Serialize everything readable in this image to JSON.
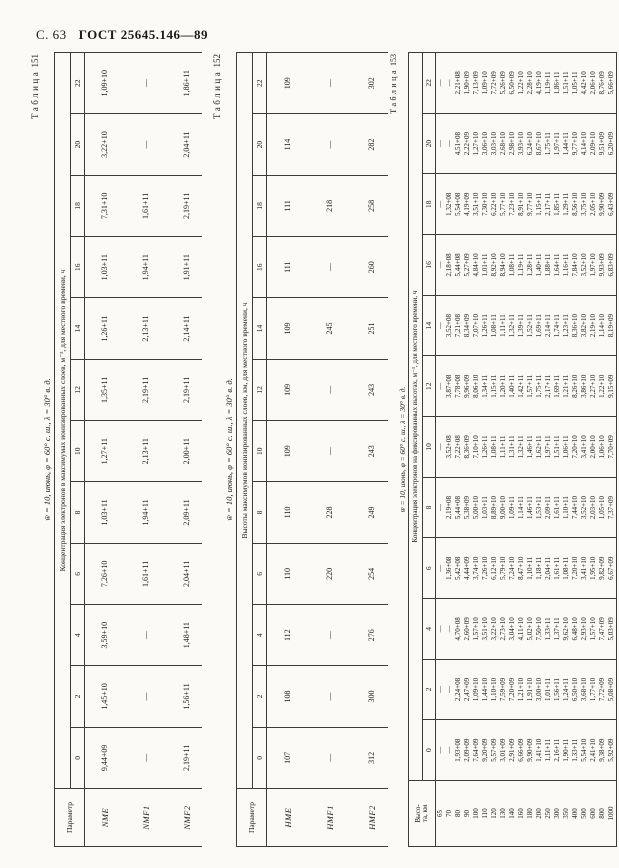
{
  "page": {
    "page_label": "С. 63",
    "gost_label": "ГОСТ 25645.146—89"
  },
  "tables": [
    {
      "label_word": "Таблица",
      "label_num": "151",
      "condition": "w̄ = 10, июнь, φ = 60° с. ш., λ = 30° в. д.",
      "caption": "Концентрация электронов в максимумах ионизированных слоев, м⁻³, для местного времени, ч",
      "corner": "Параметр",
      "hours": [
        "0",
        "2",
        "4",
        "6",
        "8",
        "10",
        "12",
        "14",
        "16",
        "18",
        "20",
        "22"
      ],
      "rows": [
        {
          "param": "NME",
          "values": [
            "9,44+09",
            "1,45+10",
            "3,59+10",
            "7,26+10",
            "1,03+11",
            "1,27+11",
            "1,35+11",
            "1,26+11",
            "1,03+11",
            "7,31+10",
            "3,22+10",
            "1,09+10"
          ]
        },
        {
          "param": "NMF1",
          "values": [
            "—",
            "—",
            "—",
            "1,61+11",
            "1,94+11",
            "2,13+11",
            "2,19+11",
            "2,13+11",
            "1,94+11",
            "1,61+11",
            "—",
            "—"
          ]
        },
        {
          "param": "NMF2",
          "values": [
            "2,19+11",
            "1,56+11",
            "1,48+11",
            "2,04+11",
            "2,09+11",
            "2,00+11",
            "2,19+11",
            "2,14+11",
            "1,91+11",
            "2,19+11",
            "2,04+11",
            "1,86+11"
          ]
        }
      ]
    },
    {
      "label_word": "Таблица",
      "label_num": "152",
      "condition": "w̄ = 10, июнь, φ = 60° с. ш., λ = 30° в. д.",
      "caption": "Высоты максимумов ионизированных слоев, км, для местного времени, ч",
      "corner": "Параметр",
      "hours": [
        "0",
        "2",
        "4",
        "6",
        "8",
        "10",
        "12",
        "14",
        "16",
        "18",
        "20",
        "22"
      ],
      "rows": [
        {
          "param": "HME",
          "values": [
            "107",
            "108",
            "112",
            "110",
            "110",
            "109",
            "109",
            "109",
            "111",
            "111",
            "114",
            "109"
          ]
        },
        {
          "param": "HMF1",
          "values": [
            "—",
            "—",
            "—",
            "220",
            "228",
            "—",
            "—",
            "245",
            "—",
            "218",
            "—",
            "—"
          ]
        },
        {
          "param": "HMF2",
          "values": [
            "312",
            "300",
            "276",
            "254",
            "249",
            "243",
            "243",
            "251",
            "260",
            "258",
            "282",
            "302"
          ]
        }
      ]
    },
    {
      "label_word": "Таблица",
      "label_num": "153",
      "condition": "w̄ = 10, июнь, φ = 60° с. ш., λ = 30° в. д.",
      "caption": "Концентрация электронов на фиксированных высотах, м⁻³, для местного времени, ч",
      "corner": "Высо-\nта, км",
      "hours": [
        "0",
        "2",
        "4",
        "6",
        "8",
        "10",
        "12",
        "14",
        "16",
        "18",
        "20",
        "22"
      ],
      "rows": [
        {
          "param": "65",
          "values": [
            "—",
            "—",
            "—",
            "—",
            "—",
            "—",
            "—",
            "—",
            "—",
            "—",
            "—",
            "—"
          ]
        },
        {
          "param": "70",
          "values": [
            "—",
            "—",
            "—",
            "1,36+08",
            "2,19+08",
            "3,52+08",
            "3,87+08",
            "3,52+08",
            "2,18+08",
            "1,32+08",
            "—",
            "—"
          ]
        },
        {
          "param": "80",
          "values": [
            "1,93+08",
            "2,24+08",
            "4,70+08",
            "5,42+08",
            "5,44+08",
            "7,22+08",
            "7,78+08",
            "7,21+08",
            "5,44+08",
            "5,54+08",
            "4,51+08",
            "2,21+08"
          ]
        },
        {
          "param": "90",
          "values": [
            "2,09+09",
            "2,47+09",
            "2,60+09",
            "4,44+09",
            "5,38+09",
            "8,36+09",
            "9,96+09",
            "8,34+09",
            "5,27+09",
            "4,19+09",
            "2,22+09",
            "1,90+09"
          ]
        },
        {
          "param": "100",
          "values": [
            "7,64+09",
            "1,09+10",
            "1,57+10",
            "3,74+10",
            "5,00+10",
            "7,10+10",
            "8,06+10",
            "7,07+10",
            "4,84+10",
            "3,51+10",
            "1,27+10",
            "7,13+09"
          ]
        },
        {
          "param": "110",
          "values": [
            "9,20+09",
            "1,44+10",
            "3,51+10",
            "7,26+10",
            "1,03+11",
            "1,26+11",
            "1,34+11",
            "1,26+11",
            "1,01+11",
            "7,30+10",
            "3,06+10",
            "1,09+10"
          ]
        },
        {
          "param": "120",
          "values": [
            "5,57+09",
            "1,10+10",
            "3,22+10",
            "6,12+10",
            "8,89+10",
            "1,08+11",
            "1,15+11",
            "1,08+11",
            "8,92+10",
            "6,22+10",
            "3,03+10",
            "7,72+09"
          ]
        },
        {
          "param": "130",
          "values": [
            "3,01+09",
            "7,59+09",
            "2,73+10",
            "5,79+10",
            "9,00+10",
            "1,11+11",
            "1,20+11",
            "1,11+11",
            "8,94+10",
            "5,77+10",
            "2,68+10",
            "5,26+09"
          ]
        },
        {
          "param": "140",
          "values": [
            "2,91+09",
            "7,20+09",
            "3,04+10",
            "7,24+10",
            "1,09+11",
            "1,31+11",
            "1,40+11",
            "1,32+11",
            "1,08+11",
            "7,23+10",
            "2,98+10",
            "6,50+09"
          ]
        },
        {
          "param": "160",
          "values": [
            "6,66+09",
            "1,21+10",
            "4,11+10",
            "8,47+10",
            "1,14+11",
            "1,32+11",
            "1,42+11",
            "1,39+11",
            "1,19+11",
            "8,91+10",
            "3,93+10",
            "1,22+10"
          ]
        },
        {
          "param": "180",
          "values": [
            "9,90+09",
            "1,91+10",
            "5,02+10",
            "1,10+11",
            "1,46+11",
            "1,46+11",
            "1,57+11",
            "1,52+11",
            "1,28+11",
            "9,77+10",
            "6,24+10",
            "2,28+10"
          ]
        },
        {
          "param": "200",
          "values": [
            "1,41+10",
            "3,00+10",
            "7,50+10",
            "1,18+11",
            "1,53+11",
            "1,62+11",
            "1,75+11",
            "1,69+11",
            "1,40+11",
            "1,15+11",
            "8,67+10",
            "4,19+10"
          ]
        },
        {
          "param": "250",
          "values": [
            "1,11+11",
            "1,01+11",
            "1,33+11",
            "2,04+11",
            "2,09+11",
            "1,97+11",
            "2,17+11",
            "2,14+11",
            "1,88+11",
            "2,17+11",
            "1,75+11",
            "1,19+11"
          ]
        },
        {
          "param": "300",
          "values": [
            "2,16+11",
            "1,56+11",
            "1,37+11",
            "1,61+11",
            "1,61+11",
            "1,51+11",
            "1,69+11",
            "1,74+11",
            "1,64+11",
            "1,85+11",
            "1,97+11",
            "1,86+11"
          ]
        },
        {
          "param": "350",
          "values": [
            "1,90+11",
            "1,24+11",
            "9,62+10",
            "1,08+11",
            "1,10+11",
            "1,06+11",
            "1,21+11",
            "1,23+11",
            "1,16+11",
            "1,29+11",
            "1,44+11",
            "1,51+11"
          ]
        },
        {
          "param": "400",
          "values": [
            "1,33+11",
            "6,50+10",
            "6,48+10",
            "7,20+10",
            "7,44+10",
            "7,20+10",
            "8,26+10",
            "8,36+10",
            "7,84+10",
            "8,56+10",
            "9,77+10",
            "1,05+11"
          ]
        },
        {
          "param": "500",
          "values": [
            "5,54+10",
            "3,68+10",
            "2,93+10",
            "3,41+10",
            "3,52+10",
            "3,41+10",
            "3,86+10",
            "3,82+10",
            "3,52+10",
            "3,75+10",
            "4,14+10",
            "4,42+10"
          ]
        },
        {
          "param": "600",
          "values": [
            "2,41+10",
            "1,77+10",
            "1,57+10",
            "1,95+10",
            "2,03+10",
            "2,00+10",
            "2,27+10",
            "2,19+10",
            "1,97+10",
            "2,05+10",
            "2,09+10",
            "2,06+10"
          ]
        },
        {
          "param": "800",
          "values": [
            "9,38+09",
            "7,72+09",
            "7,47+09",
            "9,82+09",
            "1,05+10",
            "1,06+10",
            "1,22+10",
            "1,14+10",
            "9,93+09",
            "9,90+09",
            "9,51+09",
            "8,76+09"
          ]
        },
        {
          "param": "1000",
          "values": [
            "5,92+09",
            "5,08+09",
            "5,03+09",
            "6,67+09",
            "7,37+09",
            "7,70+09",
            "9,15+09",
            "8,19+09",
            "6,83+09",
            "6,43+09",
            "6,20+09",
            "5,66+09"
          ]
        }
      ]
    }
  ]
}
